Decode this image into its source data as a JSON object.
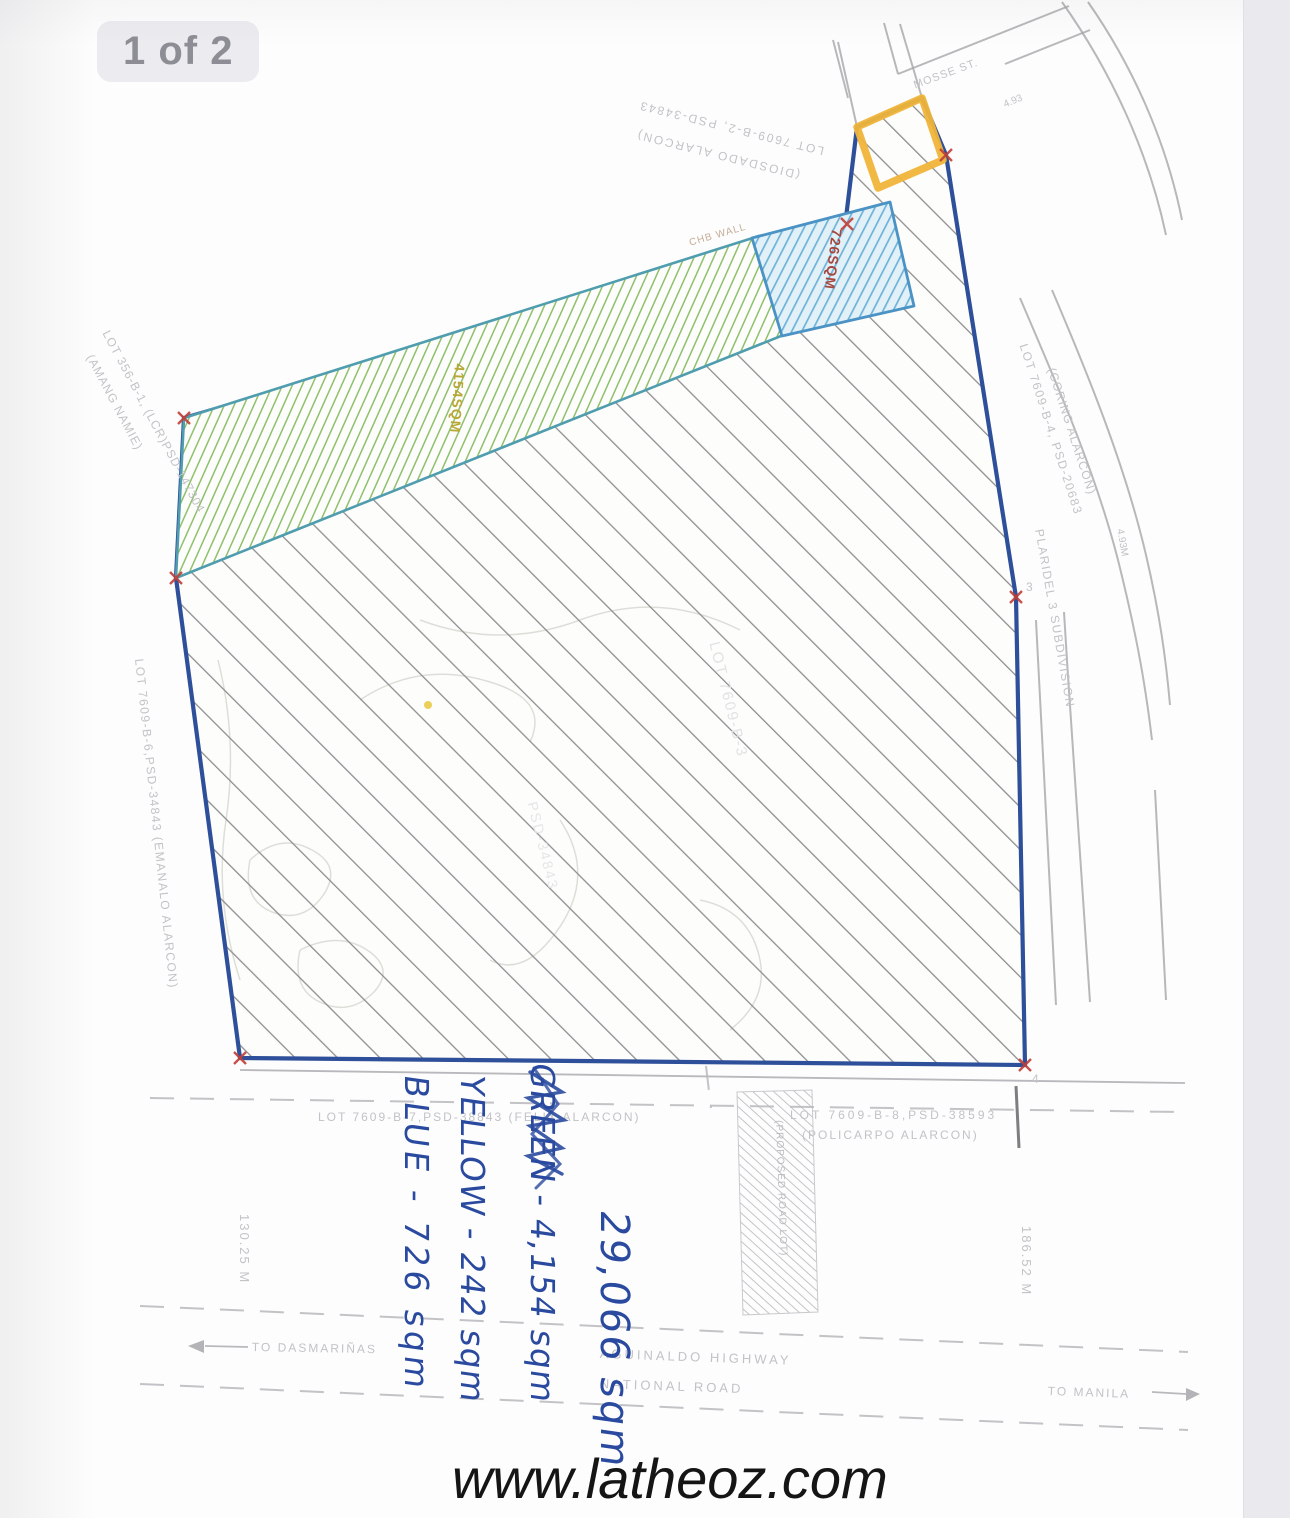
{
  "viewer": {
    "page_indicator": "1 of 2"
  },
  "watermark": "www.latheoz.com",
  "notes": {
    "total": "29,066 sqm",
    "green": "GREEN - 4,154 sqm",
    "yellow": "YELLOW - 242 sqm",
    "blue": "BLUE - 726 sqm"
  },
  "plan": {
    "zone_labels": {
      "blue_zone": "726SQM",
      "green_zone": "4154SQM"
    },
    "labels": [
      {
        "t": "726SQM",
        "x": 845,
        "y": 230,
        "r": 97,
        "s": 14,
        "c": "#a6473e",
        "w": 700,
        "ls": 1
      },
      {
        "t": "4154SQM",
        "x": 468,
        "y": 364,
        "r": 94,
        "s": 14,
        "c": "#b8a836",
        "w": 700,
        "ls": 1
      },
      {
        "t": "LOT 7609-B-2, PSD-34843",
        "x": 822,
        "y": 158,
        "r": 194,
        "s": 12,
        "ls": 2
      },
      {
        "t": "(DIOSDADO ALARCON)",
        "x": 798,
        "y": 182,
        "r": 194,
        "s": 12,
        "ls": 2
      },
      {
        "t": "LOT 356-B-1, (LCR)PSD-147304",
        "x": 112,
        "y": 328,
        "r": 62,
        "s": 12,
        "ls": 1
      },
      {
        "t": "(AMANG NAMIE)",
        "x": 96,
        "y": 352,
        "r": 62,
        "s": 12,
        "ls": 1
      },
      {
        "t": "LOT 7609-B-6,PSD-34843 (EMANALO ALARCON)",
        "x": 146,
        "y": 658,
        "r": 84,
        "s": 12,
        "ls": 1.5
      },
      {
        "t": "LOT 7609-B-4, PSD-20683",
        "x": 1030,
        "y": 342,
        "r": 72,
        "s": 12,
        "ls": 1.5
      },
      {
        "t": "(CORING ALARCON)",
        "x": 1058,
        "y": 366,
        "r": 72,
        "s": 12,
        "ls": 1
      },
      {
        "t": "PLARIDEL 3 SUBDIVISION",
        "x": 1046,
        "y": 528,
        "r": 80,
        "s": 12,
        "ls": 1.5
      },
      {
        "t": "LOT 7609-B-3",
        "x": 722,
        "y": 640,
        "r": 76,
        "s": 15,
        "c": "#e2e2e4",
        "ls": 2
      },
      {
        "t": "PSD-34843",
        "x": 540,
        "y": 800,
        "r": 76,
        "s": 14,
        "c": "#e6e6e8",
        "ls": 2
      },
      {
        "t": "CHB WALL",
        "x": 688,
        "y": 238,
        "r": -16,
        "s": 10,
        "c": "#c4ad98",
        "ls": 1
      },
      {
        "t": "MOSSE ST.",
        "x": 912,
        "y": 80,
        "r": -20,
        "s": 11,
        "ls": 1
      },
      {
        "t": "4.93",
        "x": 1002,
        "y": 100,
        "r": -22,
        "s": 10
      },
      {
        "t": "4.93M",
        "x": 1125,
        "y": 528,
        "r": 80,
        "s": 10
      },
      {
        "t": "LOT 7609-B-7,PSD-38843 (FELIX ALARCON)",
        "x": 318,
        "y": 1110,
        "r": 0,
        "s": 12,
        "ls": 2
      },
      {
        "t": "LOT 7609-B-8,PSD-38593",
        "x": 790,
        "y": 1108,
        "r": 0,
        "s": 12,
        "ls": 3
      },
      {
        "t": "(POLICARPO ALARCON)",
        "x": 802,
        "y": 1128,
        "r": 0,
        "s": 12,
        "ls": 2
      },
      {
        "t": "(PROPOSED ROAD LOT)",
        "x": 784,
        "y": 1120,
        "r": 88,
        "s": 10,
        "c": "#bbbbbf",
        "ls": 1
      },
      {
        "t": "130.25 M",
        "x": 252,
        "y": 1214,
        "r": 90,
        "s": 13,
        "ls": 2
      },
      {
        "t": "186.52 M",
        "x": 1034,
        "y": 1226,
        "r": 90,
        "s": 13,
        "ls": 2
      },
      {
        "t": "TO DASMARIÑAS",
        "x": 252,
        "y": 1340,
        "r": 1,
        "s": 12,
        "ls": 2
      },
      {
        "t": "TO MANILA",
        "x": 1048,
        "y": 1384,
        "r": 2,
        "s": 12,
        "ls": 2
      },
      {
        "t": "AGUINALDO HIGHWAY",
        "x": 600,
        "y": 1346,
        "r": 2,
        "s": 13,
        "ls": 3
      },
      {
        "t": "NATIONAL ROAD",
        "x": 600,
        "y": 1376,
        "r": 2,
        "s": 13,
        "ls": 3
      },
      {
        "t": "3",
        "x": 1026,
        "y": 580,
        "r": 0,
        "s": 12
      },
      {
        "t": "4",
        "x": 1032,
        "y": 1072,
        "r": 0,
        "s": 12
      }
    ]
  },
  "colors": {
    "ink": "#2a4aa0",
    "boundary": "#2e4f99",
    "teal": "#4f9dae",
    "blue_bg": "#e2f0f8",
    "yellow": "#f0b53a",
    "red": "#c04038"
  }
}
